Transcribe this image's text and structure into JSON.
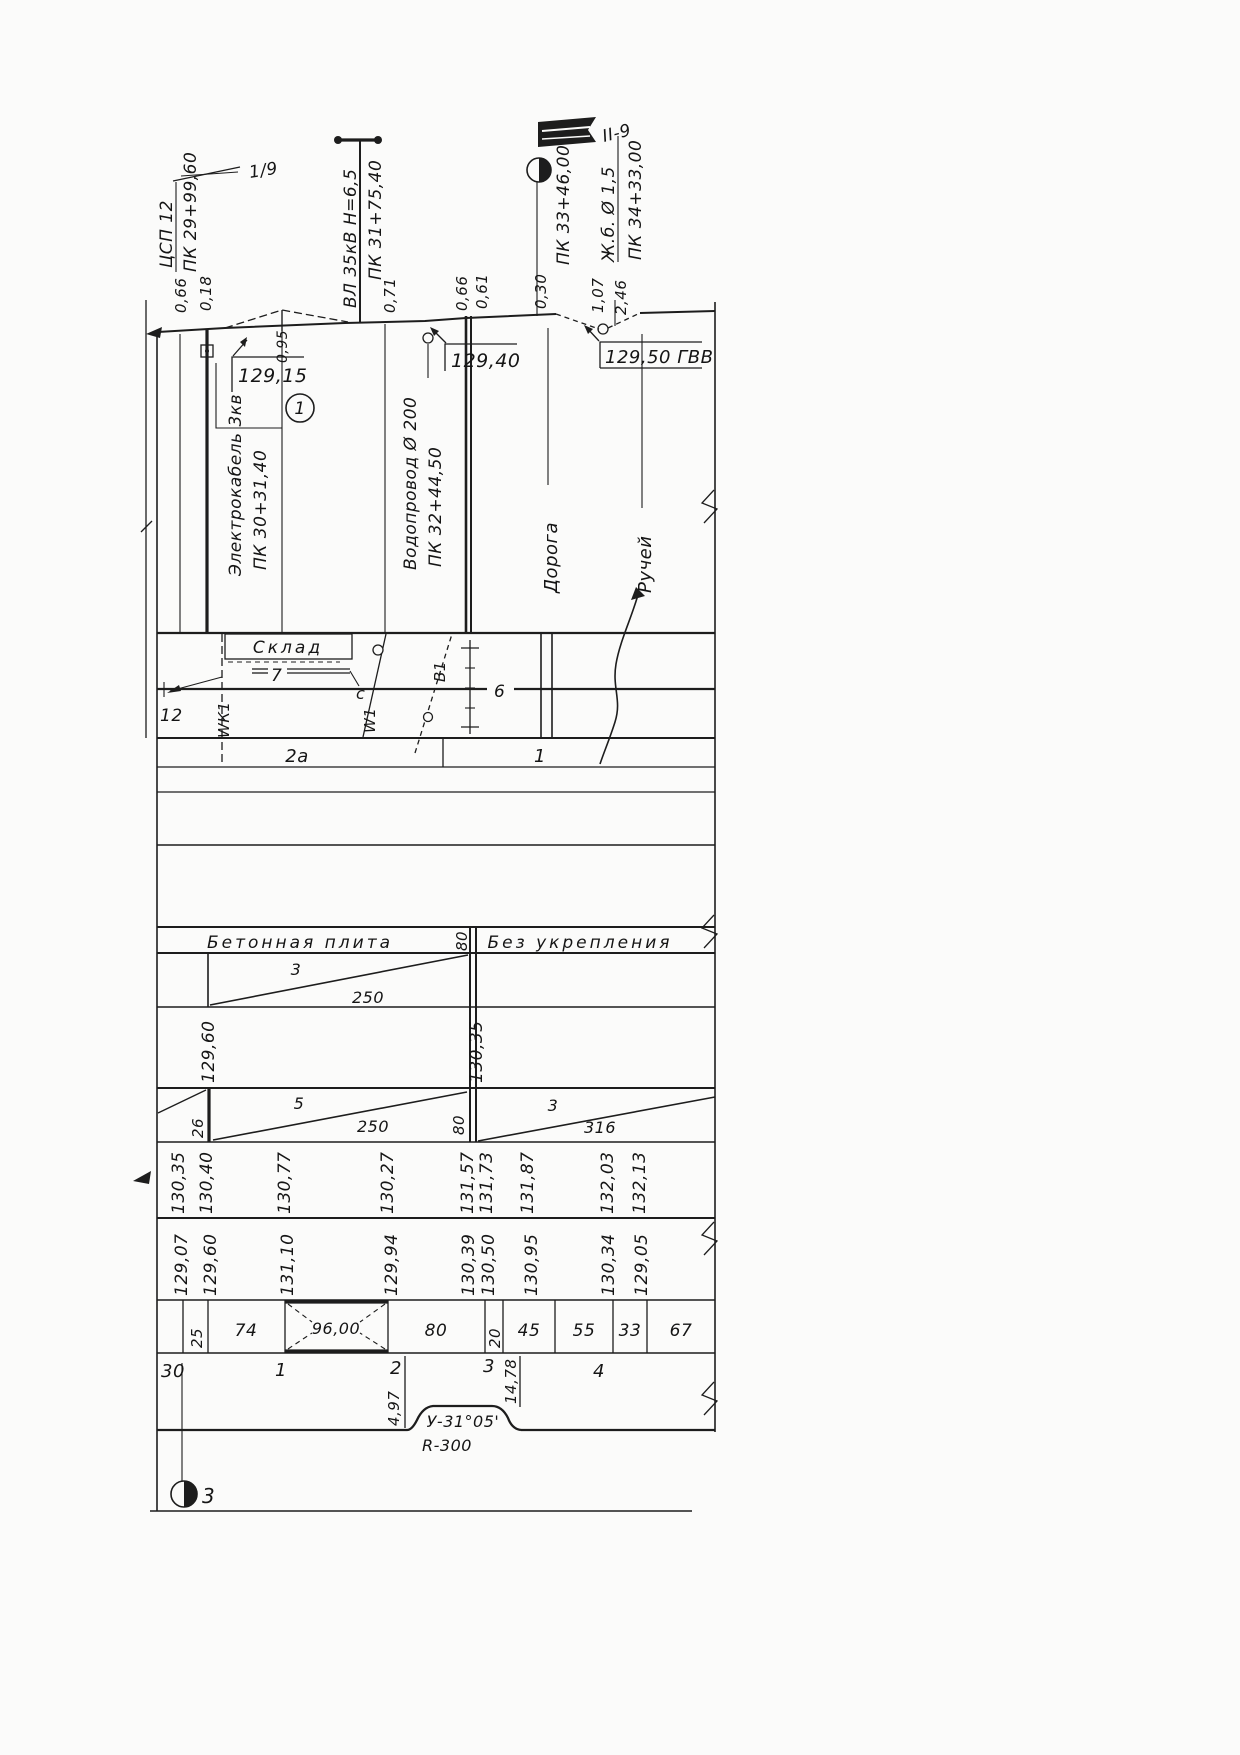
{
  "t": {
    "flag_left": "1/9",
    "csp": "ЦСП 12",
    "csp_pk": "ПК 29+99,60",
    "csp_o1": "0,66",
    "csp_o2": "0,18",
    "vl": "ВЛ 35кВ Н=6,5",
    "vl_pk": "ПК 31+75,40",
    "vl_o": "0,71",
    "w_o1": "0,66",
    "w_o2": "0,61",
    "road_o": "0,30",
    "pk33": "ПК 33+46,00",
    "flag_right": "II-9",
    "s_o1": "1,07",
    "s_o2": "2,46",
    "culvert": "Ж.б. Ø 1,5",
    "culvert_pk": "ПК 34+33,00"
  },
  "profile": {
    "e1": "129,15",
    "mound": "0,95",
    "e2": "129,40",
    "e3": "129,50 ГВВ",
    "note": "1"
  },
  "ord": {
    "cable": "Электрокабель 3кв",
    "cable_pk": "ПК 30+31,40",
    "water": "Водопровод Ø 200",
    "water_pk": "ПК 32+44,50",
    "road": "Дорога",
    "stream": "Ручей"
  },
  "plan": {
    "sklad": "Склад",
    "n7": "7",
    "c": "с",
    "n6": "6",
    "n12": "12",
    "wk1": "WК1",
    "w1": "W1",
    "b1": "В1",
    "z1": "2а",
    "z2": "1"
  },
  "surface": {
    "left": "Бетонная плита",
    "v": "80",
    "right": "Без укрепления"
  },
  "ditch1": {
    "slope": "3",
    "len": "250"
  },
  "elevA": [
    "129,60",
    "130,35"
  ],
  "ditch2": {
    "v1": "26",
    "s1": "5",
    "l1": "250",
    "v2": "80",
    "s2": "3",
    "l2": "316"
  },
  "elevB": [
    "130,35",
    "130,40",
    "130,77",
    "130,27",
    "131,57",
    "131,73",
    "131,87",
    "132,03",
    "132,13"
  ],
  "elevC": [
    "129,07",
    "129,60",
    "131,10",
    "129,94",
    "130,39",
    "130,50",
    "130,95",
    "130,34",
    "129,05"
  ],
  "dist": [
    "25",
    "74",
    "96,00",
    "80",
    "20",
    "45",
    "55",
    "33",
    "67"
  ],
  "sta": [
    "30",
    "1",
    "2",
    "3",
    "4"
  ],
  "tang": [
    "4,97",
    "14,78"
  ],
  "curve": {
    "angle": "У-31°05'",
    "radius": "R-300"
  },
  "marker3": "3",
  "colors": {
    "ink": "#1d1d1d",
    "paper": "#fbfbfa"
  }
}
